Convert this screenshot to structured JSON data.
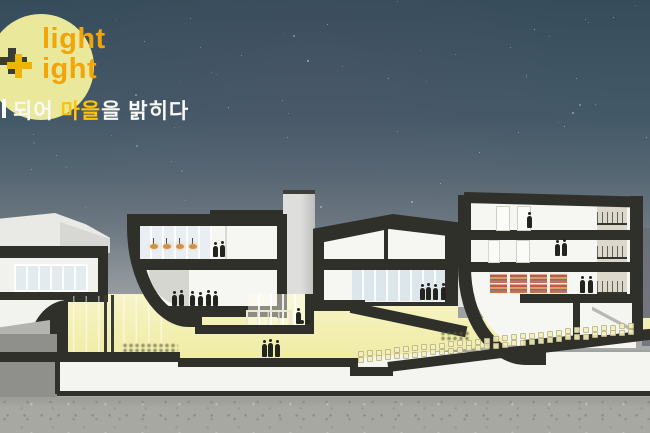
{
  "logo": {
    "line1": "light",
    "line2": "ight",
    "text_color": "#f2a50a",
    "circle_color": "#e9e89b",
    "plus_dark_color": "#3c3c36",
    "plus_yellow_color": "#f0b409"
  },
  "tagline": {
    "prefix": "되어 ",
    "highlight": "마을",
    "suffix": "을 밝히다",
    "text_color": "#f8f8f6",
    "highlight_color": "#ffc40a"
  },
  "palette": {
    "sky_top": "#364c5a",
    "sky_mid": "#4a5d6b",
    "fog": "#a3a7a8",
    "section_black": "#30302b",
    "interior_white": "#f6f6f3",
    "glow_yellow": "#f2efb0",
    "glow_yellow_bright": "#f7f4cb",
    "concrete": "#a8a8a2",
    "lamp_orange": "#d0914a",
    "facade_beige": "#ddd8cc"
  },
  "illustration": {
    "stars": {
      "count": 75,
      "area_height": 240
    },
    "lamps": [
      {
        "x": 150,
        "y": 244
      },
      {
        "x": 163,
        "y": 244
      },
      {
        "x": 176,
        "y": 244
      },
      {
        "x": 189,
        "y": 244
      }
    ],
    "people": [
      {
        "x": 213,
        "feet": 257,
        "h": 11
      },
      {
        "x": 220,
        "feet": 257,
        "h": 12
      },
      {
        "x": 172,
        "feet": 306,
        "h": 11
      },
      {
        "x": 179,
        "feet": 306,
        "h": 12
      },
      {
        "x": 190,
        "feet": 306,
        "h": 11
      },
      {
        "x": 198,
        "feet": 306,
        "h": 10
      },
      {
        "x": 206,
        "feet": 306,
        "h": 12
      },
      {
        "x": 213,
        "feet": 306,
        "h": 11
      },
      {
        "x": 296,
        "feet": 324,
        "h": 12,
        "cart": true
      },
      {
        "x": 262,
        "feet": 357,
        "h": 13
      },
      {
        "x": 268,
        "feet": 357,
        "h": 14
      },
      {
        "x": 275,
        "feet": 357,
        "h": 13
      },
      {
        "x": 420,
        "feet": 300,
        "h": 12
      },
      {
        "x": 426,
        "feet": 300,
        "h": 13
      },
      {
        "x": 433,
        "feet": 300,
        "h": 12
      },
      {
        "x": 441,
        "feet": 300,
        "h": 13
      },
      {
        "x": 527,
        "feet": 228,
        "h": 12
      },
      {
        "x": 555,
        "feet": 256,
        "h": 12
      },
      {
        "x": 562,
        "feet": 256,
        "h": 13
      },
      {
        "x": 580,
        "feet": 293,
        "h": 13
      },
      {
        "x": 588,
        "feet": 293,
        "h": 13
      }
    ],
    "bookshelves": [
      {
        "x": 489,
        "y": 272,
        "w": 17,
        "h": 20
      },
      {
        "x": 509,
        "y": 272,
        "w": 17,
        "h": 20
      },
      {
        "x": 529,
        "y": 272,
        "w": 17,
        "h": 20
      },
      {
        "x": 549,
        "y": 272,
        "w": 17,
        "h": 20
      }
    ],
    "seats": {
      "x0": 358,
      "x1": 630,
      "y0": 357,
      "y1": 328,
      "step": 9,
      "rows": 2,
      "row_offset": 6
    }
  }
}
